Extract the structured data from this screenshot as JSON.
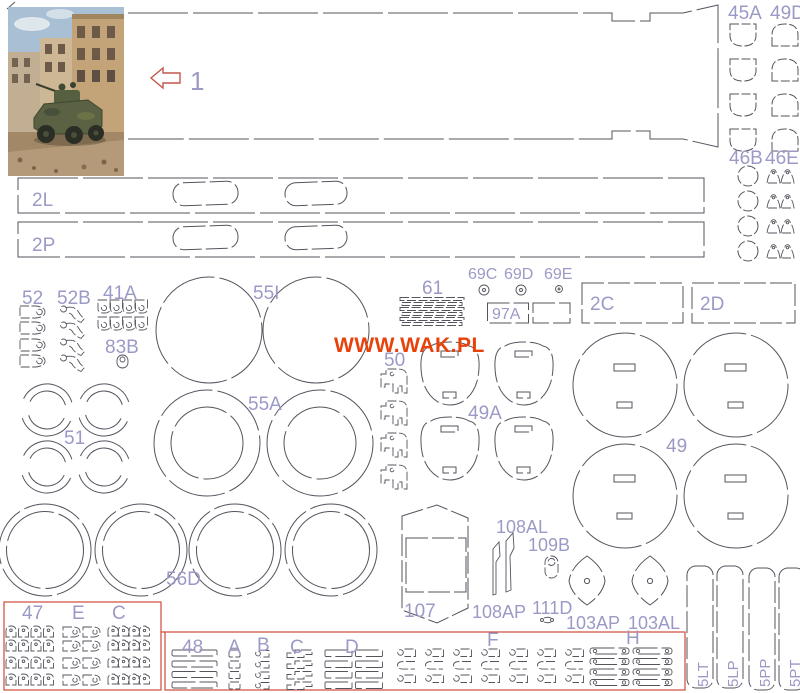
{
  "watermark": "WWW.WAK.PL",
  "colors": {
    "outline": "#54545e",
    "label": "#9b9ac6",
    "red": "#cf4a38",
    "wak": "#e8420a",
    "paper": "#ffffff"
  },
  "labels": {
    "p1": "1",
    "p2L": "2L",
    "p2P": "2P",
    "p52": "52",
    "p52B": "52B",
    "p41A": "41A",
    "p83B": "83B",
    "p55I": "55I",
    "p61": "61",
    "p69C": "69C",
    "p69D": "69D",
    "p69E": "69E",
    "p97A": "97A",
    "p2C": "2C",
    "p2D": "2D",
    "p45A": "45A",
    "p49D": "49D",
    "p46B": "46B",
    "p46E": "46E",
    "p50": "50",
    "p49A": "49A",
    "p51": "51",
    "p55A": "55A",
    "p49": "49",
    "p56D": "56D",
    "p107": "107",
    "p108AL": "108AL",
    "p108AP": "108AP",
    "p109B": "109B",
    "p111D": "111D",
    "p103AP": "103AP",
    "p103AL": "103AL",
    "p47": "47",
    "pE": "E",
    "pC_box": "C",
    "p48": "48",
    "pA": "A",
    "pB": "B",
    "pC_strip": "C",
    "pD": "D",
    "pF": "F",
    "pH": "H",
    "p5LT": "5LT",
    "p5LP": "5LP",
    "p5PP": "5PP",
    "p5PT": "5PT"
  }
}
